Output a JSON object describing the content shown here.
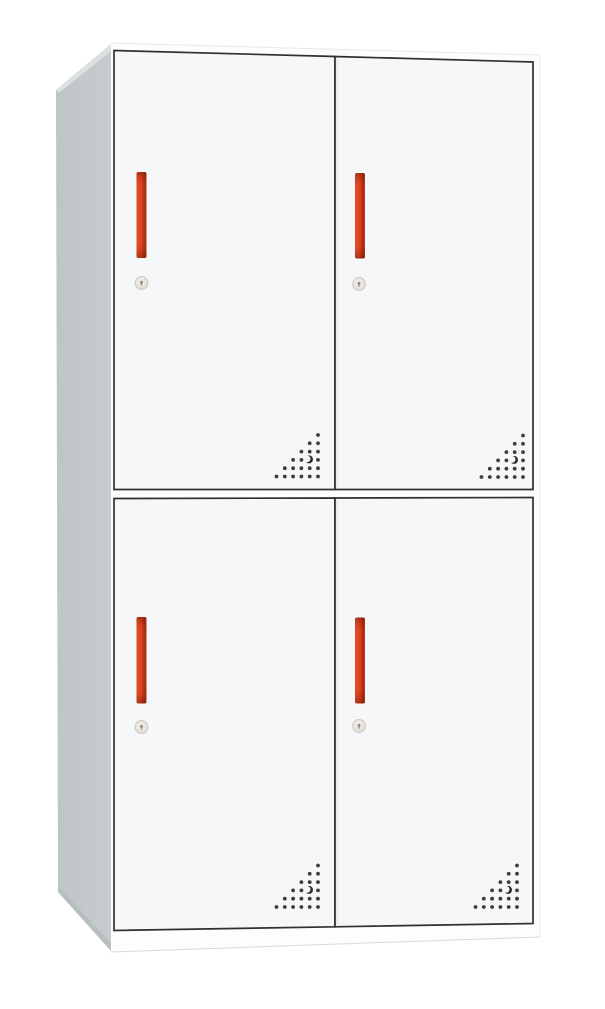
{
  "image": {
    "subject": "Four-door steel locker cabinet with red vertical handles, round cam locks and triangular corner vent perforations",
    "view": "front view angled slightly from the left, plain white background"
  },
  "cabinet": {
    "sections": 2,
    "doors_per_section": 2,
    "door_count": 4,
    "doors": [
      {
        "id": "top-left"
      },
      {
        "id": "top-right"
      },
      {
        "id": "bottom-left"
      },
      {
        "id": "bottom-right"
      }
    ],
    "handle_count": 4,
    "lock_count": 4,
    "vent": {
      "rows": 6,
      "pattern": "right-angled triangular dot grid in the lower corner of each door",
      "crescent_mark": true
    }
  },
  "colors": {
    "background": "#ffffff",
    "side_panel": "#c7cdce",
    "side_panel_back": "#bec5c7",
    "side_panel_highlight": "#dbe0e1",
    "side_panel_shadow": "#b4bbbd",
    "front_face": "#fcfdfd",
    "door_face": "#f6f7f8",
    "outline": "#303030",
    "seam_shadow": "#dfe1e3",
    "edge_faint": "#e7e9ea",
    "edge_soft": "#d8dadb",
    "handle": {
      "s0": "#d94d2b",
      "s1": "#e8491f",
      "s2": "#d63c1a",
      "s3": "#a32d11",
      "s4": "#c23818",
      "shade": "#5a1403"
    },
    "vent_dot": "#3d3d3d",
    "crescent": "#2b2b2b",
    "lock_face": "#f3f1ec",
    "lock_edge": "#dbd8d0",
    "lock_ring": "#c6c3bb",
    "lock_keyhole": "#7d766a",
    "lock_accent": "#cf9c5f"
  }
}
